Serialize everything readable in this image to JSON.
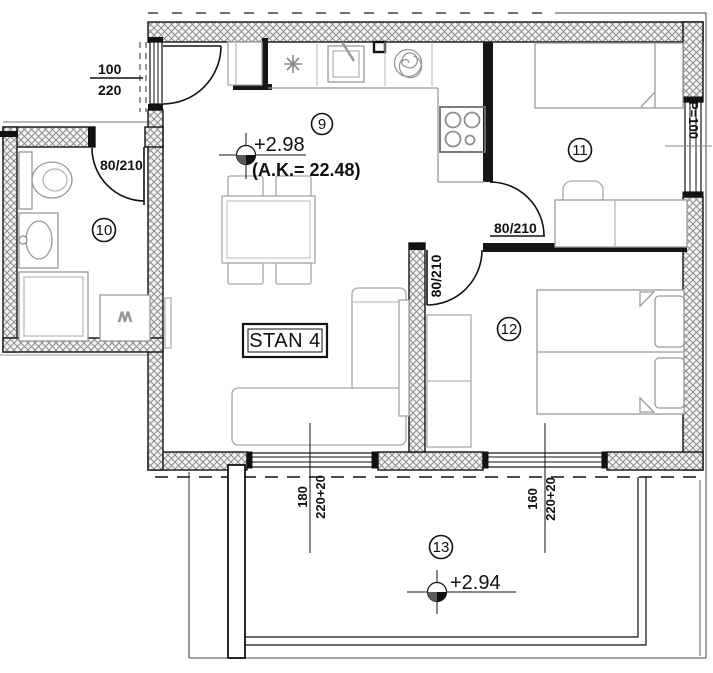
{
  "plan_label": {
    "text": "STAN 4"
  },
  "rooms": {
    "living_dining": {
      "number": "9",
      "elevation": "+2.98",
      "area_note": "(A.K.= 22.48)"
    },
    "bathroom": {
      "number": "10"
    },
    "bedroom_small": {
      "number": "11"
    },
    "bedroom_large": {
      "number": "12"
    },
    "terrace": {
      "number": "13",
      "elevation": "+2.94"
    }
  },
  "dimensions": {
    "entrance_door": {
      "width": "100",
      "height": "220"
    },
    "bathroom_door": "80/210",
    "bedroom_small_door": "80/210",
    "bedroom_large_door": "80/210",
    "parapet_window": "P=100",
    "terrace_window_left": {
      "width": "180",
      "height": "220+20"
    },
    "terrace_window_right": {
      "width": "160",
      "height": "220+20"
    }
  },
  "symbols": {
    "washing_machine": "W",
    "kitchen_unit_icon": "asterisk-icon"
  },
  "colors": {
    "ink": "#1a1a1a",
    "wall_hatch_line": "#8d8d8d",
    "furniture_line": "#a6a6a6",
    "fixture_line": "#979797"
  }
}
